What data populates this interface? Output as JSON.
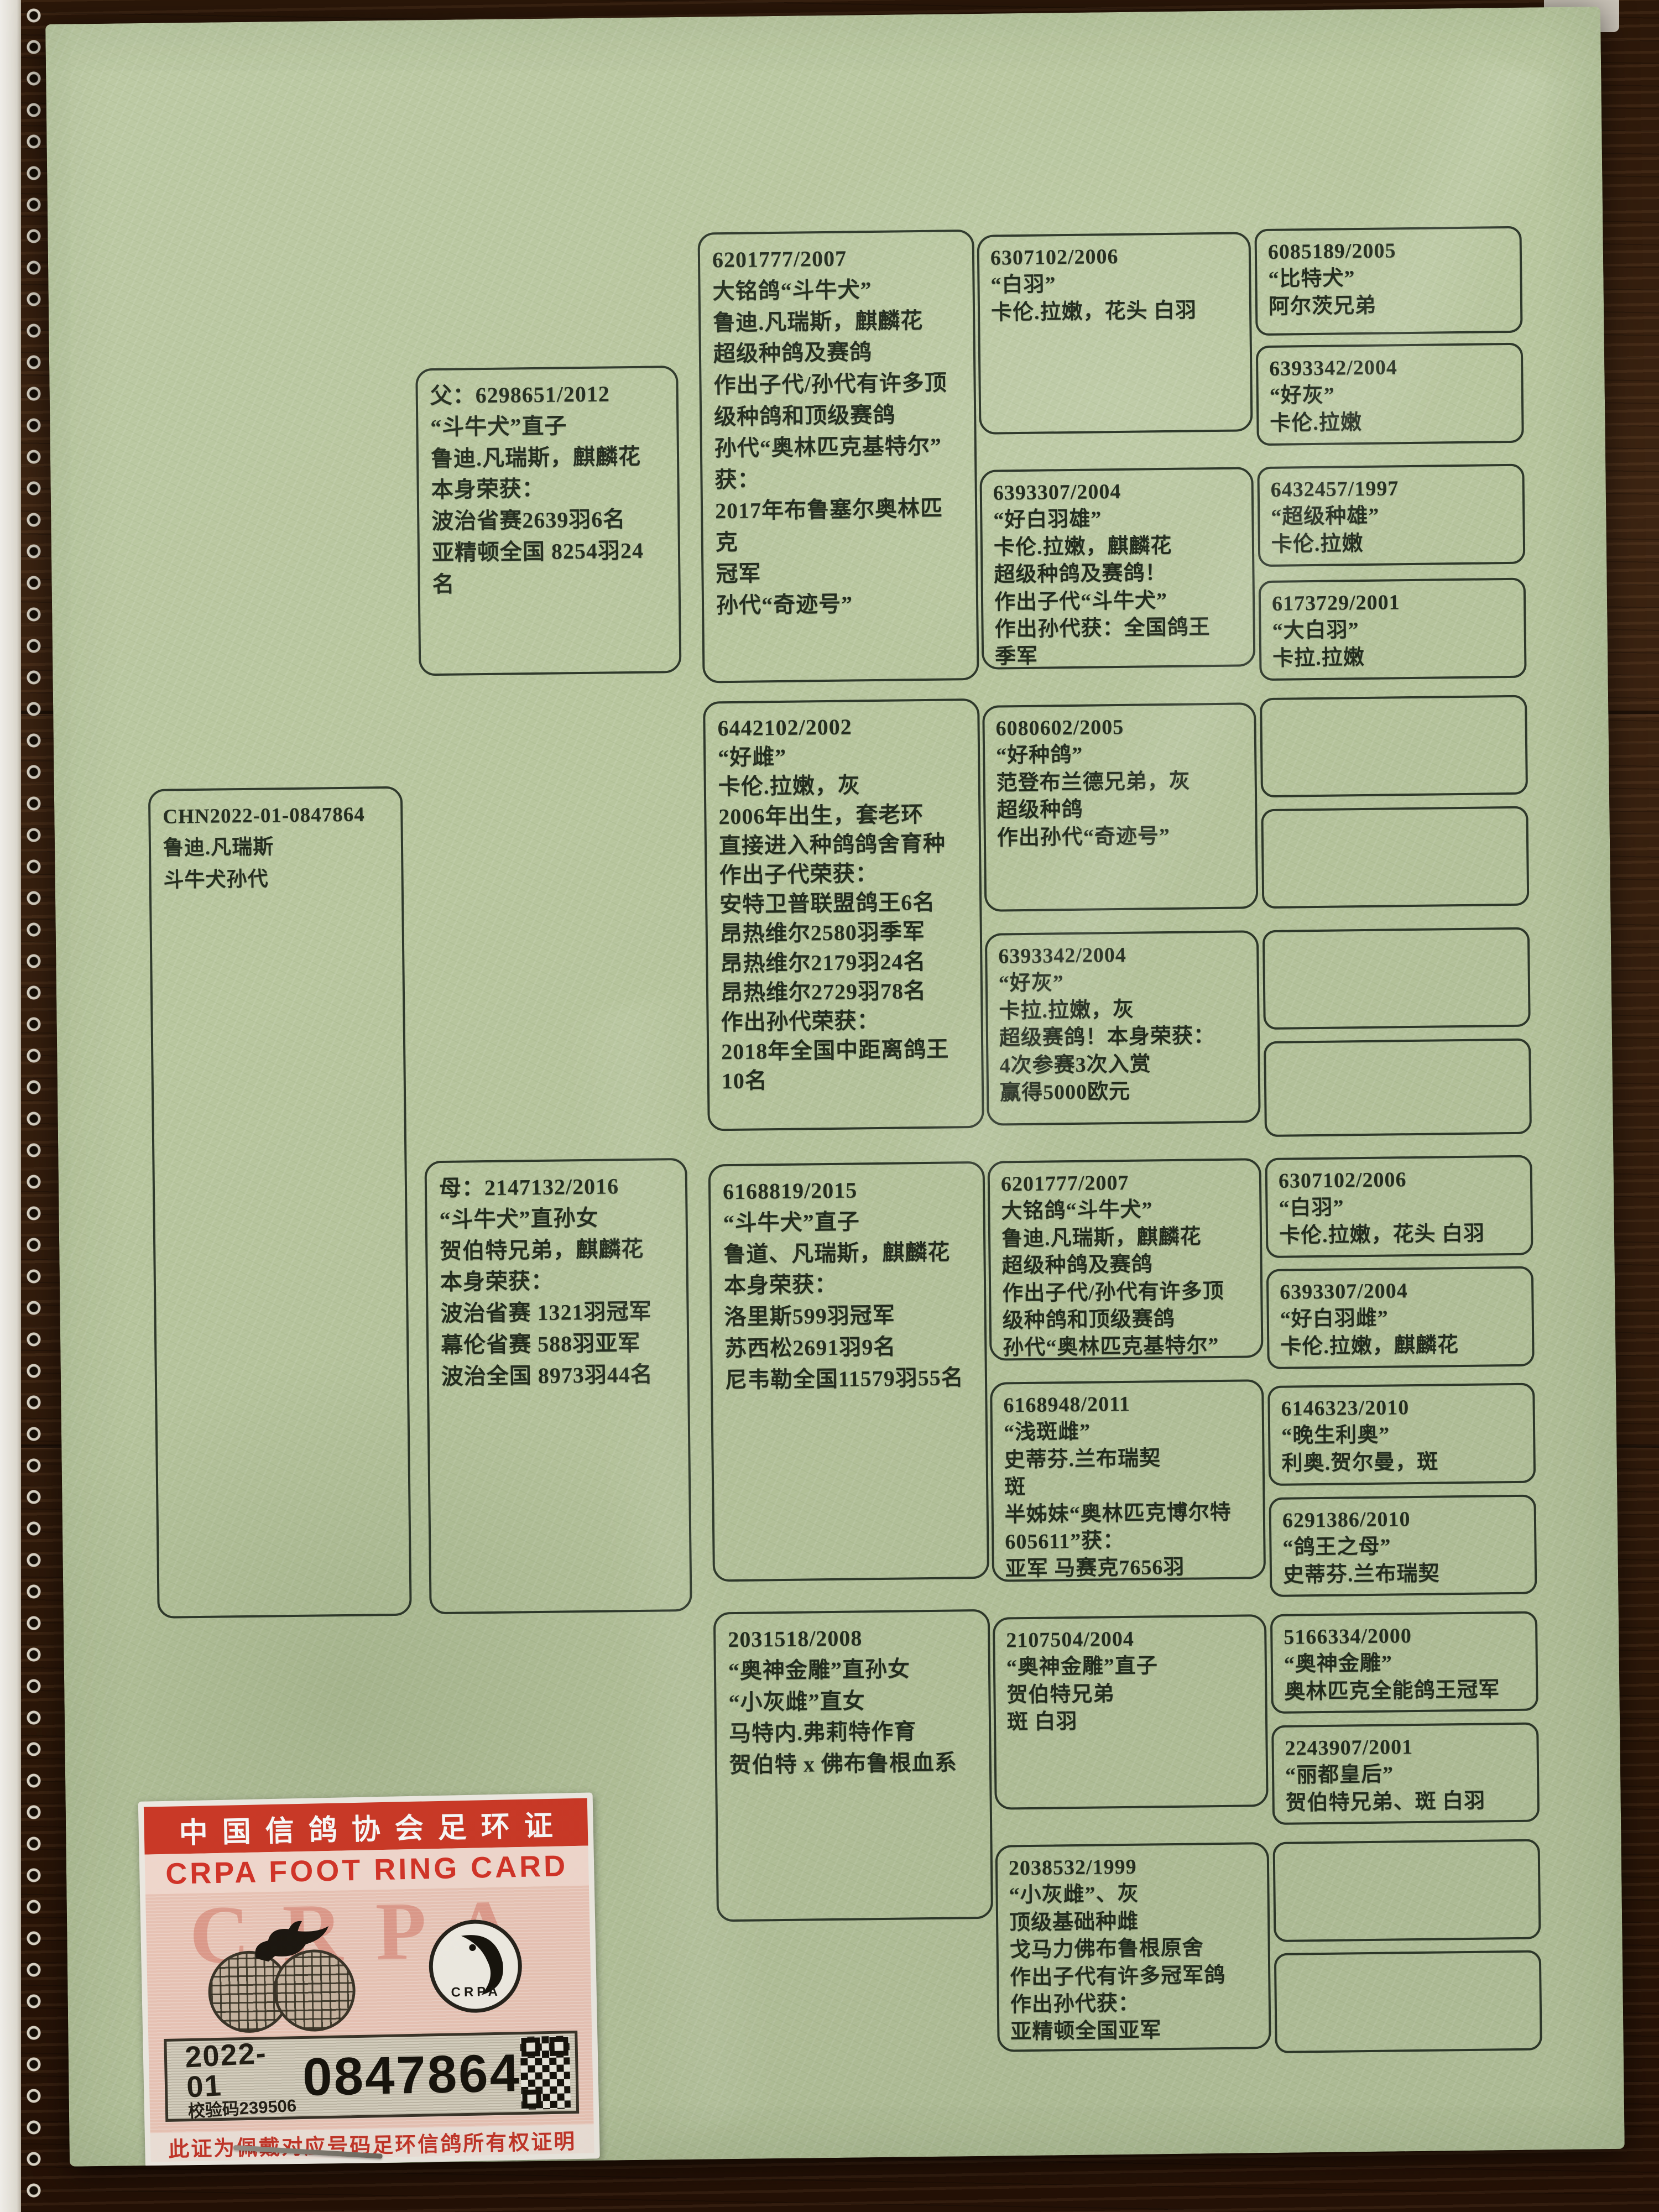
{
  "document": {
    "kind": "racing pigeon pedigree certificate",
    "paper_color": "#b8c69e",
    "ink_color": "#242d1f"
  },
  "pedigree": {
    "subject": "CHN2022-01-0847864\n鲁迪.凡瑞斯\n斗牛犬孙代",
    "father": "父：6298651/2012\n“斗牛犬”直子\n鲁迪.凡瑞斯，麒麟花\n本身荣获：\n波治省赛2639羽6名\n亚精顿全国 8254羽24名",
    "mother": "母：2147132/2016\n“斗牛犬”直孙女\n贺伯特兄弟，麒麟花\n本身荣获：\n波治省赛 1321羽冠军\n幕伦省赛 588羽亚军\n波治全国 8973羽44名",
    "gen3": [
      "6201777/2007\n大铭鸽“斗牛犬”\n鲁迪.凡瑞斯，麒麟花\n超级种鸽及赛鸽\n作出子代/孙代有许多顶\n级种鸽和顶级赛鸽\n孙代“奥林匹克基特尔”\n获：\n2017年布鲁塞尔奥林匹克\n冠军\n孙代“奇迹号”",
      "6442102/2002\n“好雌”\n卡伦.拉嫩，灰\n2006年出生，套老环\n直接进入种鸽鸽舍育种\n作出子代荣获：\n安特卫普联盟鸽王6名\n昂热维尔2580羽季军\n昂热维尔2179羽24名\n昂热维尔2729羽78名\n作出孙代荣获：\n2018年全国中距离鸽王\n10名",
      "6168819/2015\n“斗牛犬”直子\n鲁道、凡瑞斯，麒麟花\n本身荣获：\n洛里斯599羽冠军\n苏西松2691羽9名\n尼韦勒全国11579羽55名",
      "2031518/2008\n“奥神金雕”直孙女\n“小灰雌”直女\n马特内.弗莉特作育\n贺伯特 x 佛布鲁根血系"
    ],
    "gen4": [
      "6307102/2006\n“白羽”\n卡伦.拉嫩，花头 白羽",
      "6393307/2004\n“好白羽雄”\n卡伦.拉嫩，麒麟花\n超级种鸽及赛鸽！\n作出子代“斗牛犬”\n作出孙代获：全国鸽王\n季军",
      "6080602/2005\n“好种鸽”\n范登布兰德兄弟，灰\n超级种鸽\n作出孙代“奇迹号”",
      "6393342/2004\n“好灰”\n卡拉.拉嫩，灰\n超级赛鸽！本身荣获：\n4次参赛3次入赏\n赢得5000欧元",
      "6201777/2007\n大铭鸽“斗牛犬”\n鲁迪.凡瑞斯，麒麟花\n超级种鸽及赛鸽\n作出子代/孙代有许多顶\n级种鸽和顶级赛鸽\n孙代“奥林匹克基特尔”",
      "6168948/2011\n“浅斑雌”\n史蒂芬.兰布瑞契\n斑\n半姊妹“奥林匹克博尔特\n605611”获：\n亚军 马赛克7656羽",
      "2107504/2004\n“奥神金雕”直子\n贺伯特兄弟\n斑 白羽",
      "2038532/1999\n“小灰雌”、灰\n顶级基础种雌\n戈马力佛布鲁根原舍\n作出子代有许多冠军鸽\n作出孙代获：\n亚精顿全国亚军"
    ],
    "gen5": [
      "6085189/2005\n“比特犬”\n阿尔茨兄弟",
      "6393342/2004\n“好灰”\n卡伦.拉嫩",
      "6432457/1997\n“超级种雄”\n卡伦.拉嫩",
      "6173729/2001\n“大白羽”\n卡拉.拉嫩",
      "",
      "",
      "",
      "",
      "6307102/2006\n“白羽”\n卡伦.拉嫩，花头 白羽",
      "6393307/2004\n“好白羽雌”\n卡伦.拉嫩，麒麟花",
      "6146323/2010\n“晚生利奥”\n利奥.贺尔曼，斑",
      "6291386/2010\n“鸽王之母”\n史蒂芬.兰布瑞契",
      "5166334/2000\n“奥神金雕”\n奥林匹克全能鸽王冠军",
      "2243907/2001\n“丽都皇后”\n贺伯特兄弟、斑 白羽",
      "",
      ""
    ]
  },
  "ring_card": {
    "title_cn": "中国信鸽协会足环证",
    "title_en": "CRPA FOOT RING CARD",
    "year_series": "2022-01",
    "check_code": "校验码239506",
    "ring_number": "0847864",
    "footer": "此证为佩戴对应号码足环信鸽所有权证明",
    "watermark": "CRPA",
    "crpa_label": "CRPA",
    "colors": {
      "band_red": "#d03a28",
      "body_pink": "#efc8ba"
    }
  }
}
